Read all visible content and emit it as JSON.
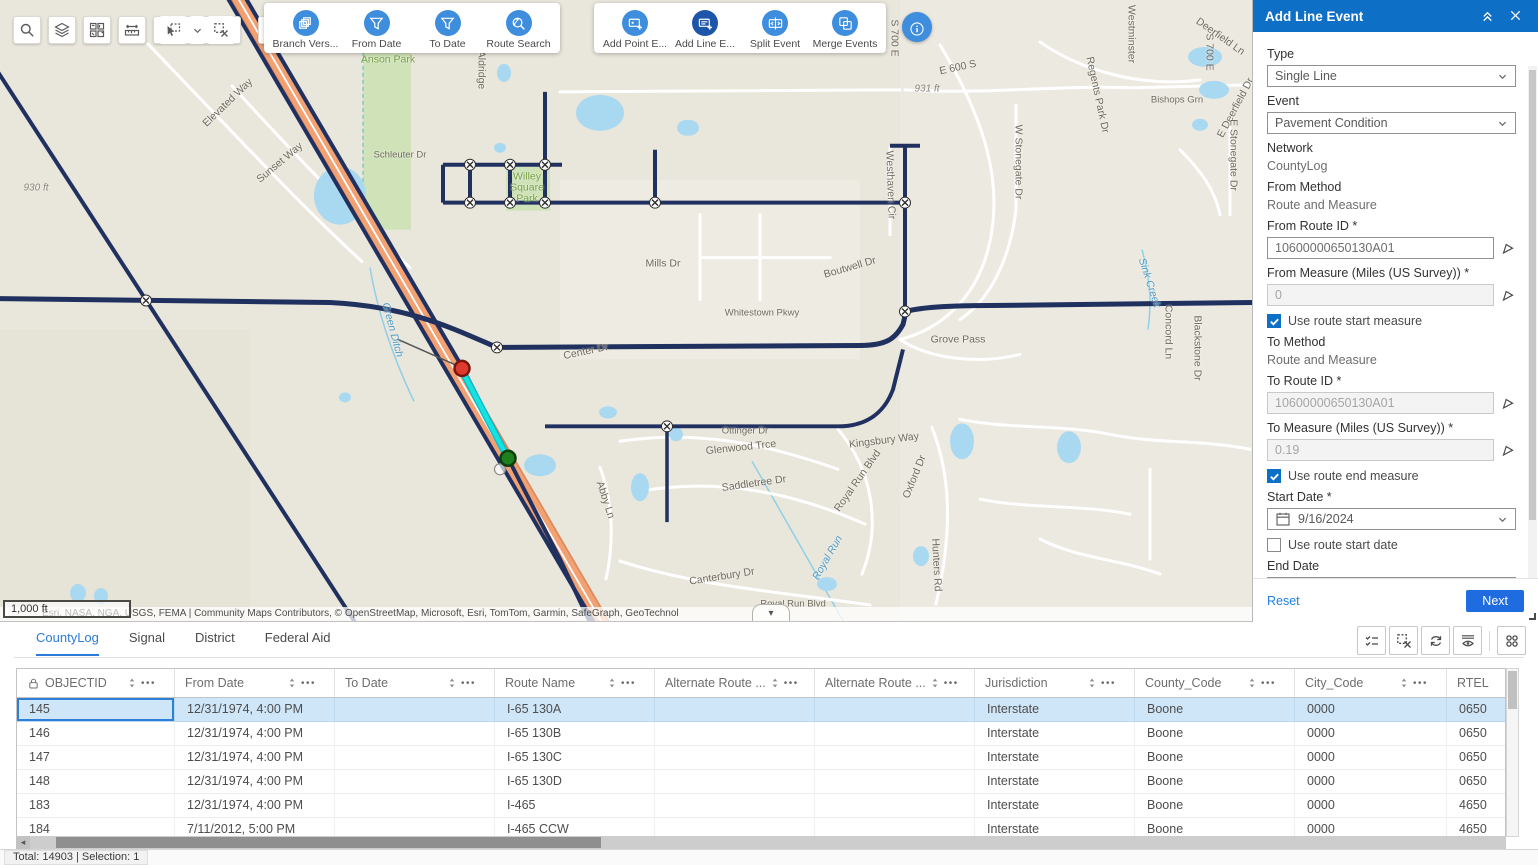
{
  "map": {
    "scale_label": "1,000 ft",
    "attribution": "Esri, NASA, NGA, USGS, FEMA | Community Maps Contributors, © OpenStreetMap, Microsoft, Esri, TomTom, Garmin, SafeGraph, GeoTechnol",
    "labels": [
      {
        "t": "Elevated Way",
        "x": 228,
        "y": 103,
        "r": -44
      },
      {
        "t": "Sunset Way",
        "x": 280,
        "y": 163,
        "r": -40
      },
      {
        "t": "Aldridge",
        "x": 481,
        "y": 70,
        "r": 90
      },
      {
        "t": "Schleuter Dr",
        "x": 400,
        "y": 155,
        "r": 0,
        "k": "small"
      },
      {
        "t": "Anson Park",
        "x": 388,
        "y": 60,
        "r": 0,
        "k": "park"
      },
      {
        "t": "Willey\nSquare\nPark",
        "x": 527,
        "y": 188,
        "r": 0,
        "k": "park"
      },
      {
        "t": "930 ft",
        "x": 36,
        "y": 188,
        "r": 0,
        "k": "elev"
      },
      {
        "t": "931 ft",
        "x": 927,
        "y": 89,
        "r": 0,
        "k": "elev"
      },
      {
        "t": "E 600 S",
        "x": 958,
        "y": 68,
        "r": -12
      },
      {
        "t": "S 700 E",
        "x": 894,
        "y": 38,
        "r": 90
      },
      {
        "t": "S 700 E",
        "x": 1209,
        "y": 52,
        "r": 90
      },
      {
        "t": "Westminster",
        "x": 1131,
        "y": 34,
        "r": 90
      },
      {
        "t": "Regents Park Dr",
        "x": 1097,
        "y": 95,
        "r": 78
      },
      {
        "t": "Deerfield Ln",
        "x": 1220,
        "y": 37,
        "r": 35
      },
      {
        "t": "E Deerfield Dr",
        "x": 1236,
        "y": 108,
        "r": -62
      },
      {
        "t": "Bishops Grn",
        "x": 1177,
        "y": 100,
        "r": 0,
        "k": "small"
      },
      {
        "t": "W Stonegate Dr",
        "x": 1018,
        "y": 162,
        "r": 90
      },
      {
        "t": "E Stonegate Dr",
        "x": 1233,
        "y": 155,
        "r": 90
      },
      {
        "t": "Westhaven Cir",
        "x": 890,
        "y": 185,
        "r": 88
      },
      {
        "t": "Mills Dr",
        "x": 663,
        "y": 264,
        "r": 0
      },
      {
        "t": "Boutwell Dr",
        "x": 850,
        "y": 268,
        "r": -16
      },
      {
        "t": "Whitestown Pkwy",
        "x": 762,
        "y": 313,
        "r": 0,
        "k": "small"
      },
      {
        "t": "Sink Creek",
        "x": 1149,
        "y": 283,
        "r": 72,
        "k": "water"
      },
      {
        "t": "Green Ditch",
        "x": 392,
        "y": 330,
        "r": 75,
        "k": "water"
      },
      {
        "t": "Concord Ln",
        "x": 1168,
        "y": 332,
        "r": 90
      },
      {
        "t": "Blackstone Dr",
        "x": 1197,
        "y": 348,
        "r": 90
      },
      {
        "t": "Grove Pass",
        "x": 958,
        "y": 340,
        "r": 0
      },
      {
        "t": "Center Dr",
        "x": 586,
        "y": 352,
        "r": -12
      },
      {
        "t": "Kingsbury Way",
        "x": 884,
        "y": 441,
        "r": -7
      },
      {
        "t": "Glenwood Trce",
        "x": 741,
        "y": 448,
        "r": -6
      },
      {
        "t": "Ottinger Dr",
        "x": 745,
        "y": 431,
        "r": 0,
        "k": "small"
      },
      {
        "t": "Saddletree Dr",
        "x": 754,
        "y": 484,
        "r": -8
      },
      {
        "t": "Royal Run Blvd",
        "x": 858,
        "y": 481,
        "r": -55
      },
      {
        "t": "Oxford Dr",
        "x": 915,
        "y": 477,
        "r": -68
      },
      {
        "t": "Royal Run",
        "x": 828,
        "y": 558,
        "r": -60,
        "k": "water"
      },
      {
        "t": "Abby Ln",
        "x": 605,
        "y": 500,
        "r": 72
      },
      {
        "t": "Hunters Rd",
        "x": 936,
        "y": 565,
        "r": 87
      },
      {
        "t": "Canterbury Dr",
        "x": 722,
        "y": 577,
        "r": -9
      },
      {
        "t": "Royal Run Blvd",
        "x": 793,
        "y": 604,
        "r": 0,
        "k": "small"
      }
    ]
  },
  "toolbar": {
    "map_tools": [
      {
        "name": "search-tool",
        "icon": "search"
      },
      {
        "name": "layers-tool",
        "icon": "layers"
      },
      {
        "name": "basemap-gallery-tool",
        "icon": "basemap"
      },
      {
        "name": "measure-tool",
        "icon": "measure"
      }
    ],
    "select_group": [
      {
        "name": "select-tool",
        "icon": "selectcursor"
      },
      {
        "name": "select-dropdown",
        "icon": "chevron",
        "small": true
      },
      {
        "name": "clear-selection-tool",
        "icon": "clearsel"
      }
    ],
    "extra_tool": {
      "name": "select-by-attribute-tool",
      "icon": "attrsel"
    },
    "groups": [
      {
        "items": [
          {
            "label": "Branch Vers...",
            "icon": "branch",
            "name": "branch-version-button"
          },
          {
            "label": "From Date",
            "icon": "filter",
            "name": "from-date-button"
          },
          {
            "label": "To Date",
            "icon": "filter",
            "name": "to-date-button"
          },
          {
            "label": "Route Search",
            "icon": "routesearch",
            "name": "route-search-button"
          }
        ]
      },
      {
        "items": [
          {
            "label": "Add Point E...",
            "icon": "addpoint",
            "name": "add-point-event-button"
          },
          {
            "label": "Add Line E...",
            "icon": "addline",
            "name": "add-line-event-button",
            "active": true
          },
          {
            "label": "Split Event",
            "icon": "split",
            "name": "split-event-button"
          },
          {
            "label": "Merge Events",
            "icon": "merge",
            "name": "merge-events-button"
          }
        ]
      }
    ]
  },
  "panel": {
    "title": "Add Line Event",
    "type": {
      "label": "Type",
      "value": "Single Line"
    },
    "event": {
      "label": "Event",
      "value": "Pavement Condition"
    },
    "network": {
      "label": "Network",
      "value": "CountyLog"
    },
    "from_method": {
      "label": "From Method",
      "value": "Route and Measure"
    },
    "from_route": {
      "label": "From Route ID *",
      "value": "10600000650130A01"
    },
    "from_measure": {
      "label": "From Measure (Miles (US Survey)) *",
      "value": "0"
    },
    "use_route_start_measure": {
      "label": "Use route start measure",
      "checked": true
    },
    "to_method": {
      "label": "To Method",
      "value": "Route and Measure"
    },
    "to_route": {
      "label": "To Route ID *",
      "value": "10600000650130A01"
    },
    "to_measure": {
      "label": "To Measure (Miles (US Survey)) *",
      "value": "0.19"
    },
    "use_route_end_measure": {
      "label": "Use route end measure",
      "checked": true
    },
    "start_date": {
      "label": "Start Date *",
      "value": "9/16/2024"
    },
    "use_route_start_date": {
      "label": "Use route start date",
      "checked": false
    },
    "end_date": {
      "label": "End Date",
      "placeholder": "MM/DD/YYYY"
    },
    "use_route_end_date": {
      "label": "Use route end date",
      "checked": false
    },
    "reset_label": "Reset",
    "next_label": "Next"
  },
  "table": {
    "tabs": [
      {
        "label": "CountyLog",
        "active": true
      },
      {
        "label": "Signal",
        "active": false
      },
      {
        "label": "District",
        "active": false
      },
      {
        "label": "Federal Aid",
        "active": false
      }
    ],
    "toolbar_icons": [
      {
        "name": "show-selected-records-button",
        "icon": "checklist"
      },
      {
        "name": "clear-table-selection-button",
        "icon": "clearsel2"
      },
      {
        "name": "refresh-button",
        "icon": "refresh"
      },
      {
        "name": "toggle-column-visibility-button",
        "icon": "eyecols"
      },
      {
        "name": "table-options-button",
        "icon": "appsgrid"
      }
    ],
    "columns": [
      {
        "label": "OBJECTID",
        "locked": true
      },
      {
        "label": "From Date"
      },
      {
        "label": "To Date"
      },
      {
        "label": "Route Name"
      },
      {
        "label": "Alternate Route ..."
      },
      {
        "label": "Alternate Route ..."
      },
      {
        "label": "Jurisdiction"
      },
      {
        "label": "County_Code"
      },
      {
        "label": "City_Code"
      },
      {
        "label": "RTEL",
        "plain": true
      }
    ],
    "selected_index": 0,
    "rows": [
      [
        "145",
        "12/31/1974, 4:00 PM",
        "",
        "I-65 130A",
        "",
        "",
        "Interstate",
        "Boone",
        "0000",
        "0650"
      ],
      [
        "146",
        "12/31/1974, 4:00 PM",
        "",
        "I-65 130B",
        "",
        "",
        "Interstate",
        "Boone",
        "0000",
        "0650"
      ],
      [
        "147",
        "12/31/1974, 4:00 PM",
        "",
        "I-65 130C",
        "",
        "",
        "Interstate",
        "Boone",
        "0000",
        "0650"
      ],
      [
        "148",
        "12/31/1974, 4:00 PM",
        "",
        "I-65 130D",
        "",
        "",
        "Interstate",
        "Boone",
        "0000",
        "0650"
      ],
      [
        "183",
        "12/31/1974, 4:00 PM",
        "",
        "I-465",
        "",
        "",
        "Interstate",
        "Boone",
        "0000",
        "4650"
      ],
      [
        "184",
        "7/11/2012, 5:00 PM",
        "",
        "I-465 CCW",
        "",
        "",
        "Interstate",
        "Boone",
        "0000",
        "4650"
      ]
    ],
    "status": "Total: 14903 | Selection: 1"
  },
  "colors": {
    "panel_header": "#0e6fc6",
    "tool_icon_blue": "#3f8ede",
    "tool_icon_active": "#1d55a8",
    "accent": "#2b7cd8",
    "selected_row": "#cfe6f8",
    "route_navy": "#20305f",
    "selection_cyan": "#14e3e0",
    "highway_orange": "#f2a173",
    "marker_red": "#df3a2e",
    "marker_green": "#1e7f1e"
  }
}
